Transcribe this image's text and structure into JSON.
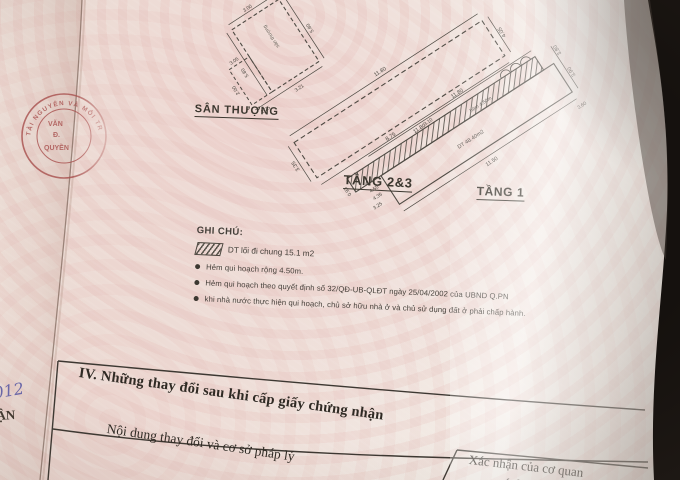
{
  "colors": {
    "background_dark": "#16130f",
    "paper_pink": "#eed3d0",
    "paper_base": "#f1ebe4",
    "ink": "#45403a",
    "stamp_red": "#a84f4d",
    "handwriting_blue": "#6a68ab"
  },
  "plans": {
    "san_thuong": {
      "label": "SÂN THƯỢNG",
      "room_label": "sân thượng",
      "dims": [
        "5.80",
        "5.80",
        "3.00",
        "2.25",
        "3.21",
        "2.00",
        "3.05"
      ]
    },
    "tang23": {
      "label": "TẦNG 2&3",
      "dims": [
        "11.80",
        "11.80",
        "3.35",
        "4.05"
      ]
    },
    "tang1": {
      "label": "TẦNG 1",
      "area_label": "DT 48.40m2",
      "alley_label": "hẻm 4.50m",
      "dims": [
        "11.80",
        "8.75",
        "11.50",
        "3.90",
        "3.80",
        "3.60",
        "3.10",
        "4.55",
        "4.35",
        "3.25",
        "0.93"
      ]
    }
  },
  "legend": {
    "title": "GHI CHÚ:",
    "hatch_item": "DT lối đi chung 15.1 m2",
    "bullets": [
      "Hẻm qui hoạch rộng 4.50m.",
      "Hẻm qui hoạch theo quyết định số 32/QĐ-UB-QLĐT ngày 25/04/2002 của UBND Q.PN",
      "khi nhà nước thực hiện qui hoạch, chủ sở hữu nhà ở và chủ sử dụng đất ở phải chấp hành."
    ]
  },
  "section4": {
    "heading": "IV. Những thay đổi sau khi cấp giấy chứng nhận",
    "left_header": "Nội dung thay đổi và cơ sở pháp lý",
    "right_header_line1": "Xác nhận của cơ quan",
    "right_header_line2": "có thẩm quyền"
  },
  "stamp": {
    "arc_text": "TÀI NGUYÊN VÀ MÔI TR",
    "line1": "VĂN",
    "line2": "Đ.",
    "line3": "QUYỀN"
  },
  "margin_notes": {
    "handwritten": "012",
    "printed": "ẬN"
  }
}
